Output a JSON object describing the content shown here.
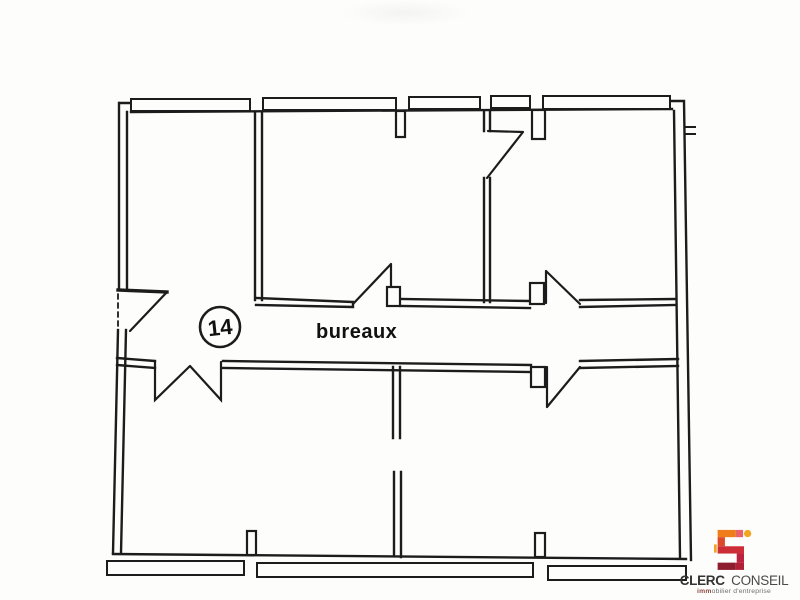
{
  "page": {
    "background_color": "#fdfdfc"
  },
  "floor_plan": {
    "unit_number": "14",
    "room_label": "bureaux",
    "line_color": "#1c1c1c",
    "features": {
      "corridor": "central horizontal corridor labeled bureaux",
      "entrance": "dashed door opening on left exterior wall with swing",
      "double_door": "double-leaf door between corridor and lower-left room",
      "windows": "window bands along top and bottom exterior walls"
    }
  },
  "logo": {
    "company_primary": "CLERC",
    "company_secondary": "CONSEIL",
    "tagline_bold": "imm",
    "tagline_rest": "obilier d'entreprise",
    "mark_icon": "s-monogram",
    "colors": {
      "orange": "#ef7d1a",
      "yellow": "#f2a51e",
      "pink": "#e8626b",
      "red": "#cd2d36",
      "crimson": "#bb2340",
      "maroon": "#8e1e2d",
      "text_dark": "#3a3a3a",
      "text_gray": "#6e6e6e"
    }
  }
}
